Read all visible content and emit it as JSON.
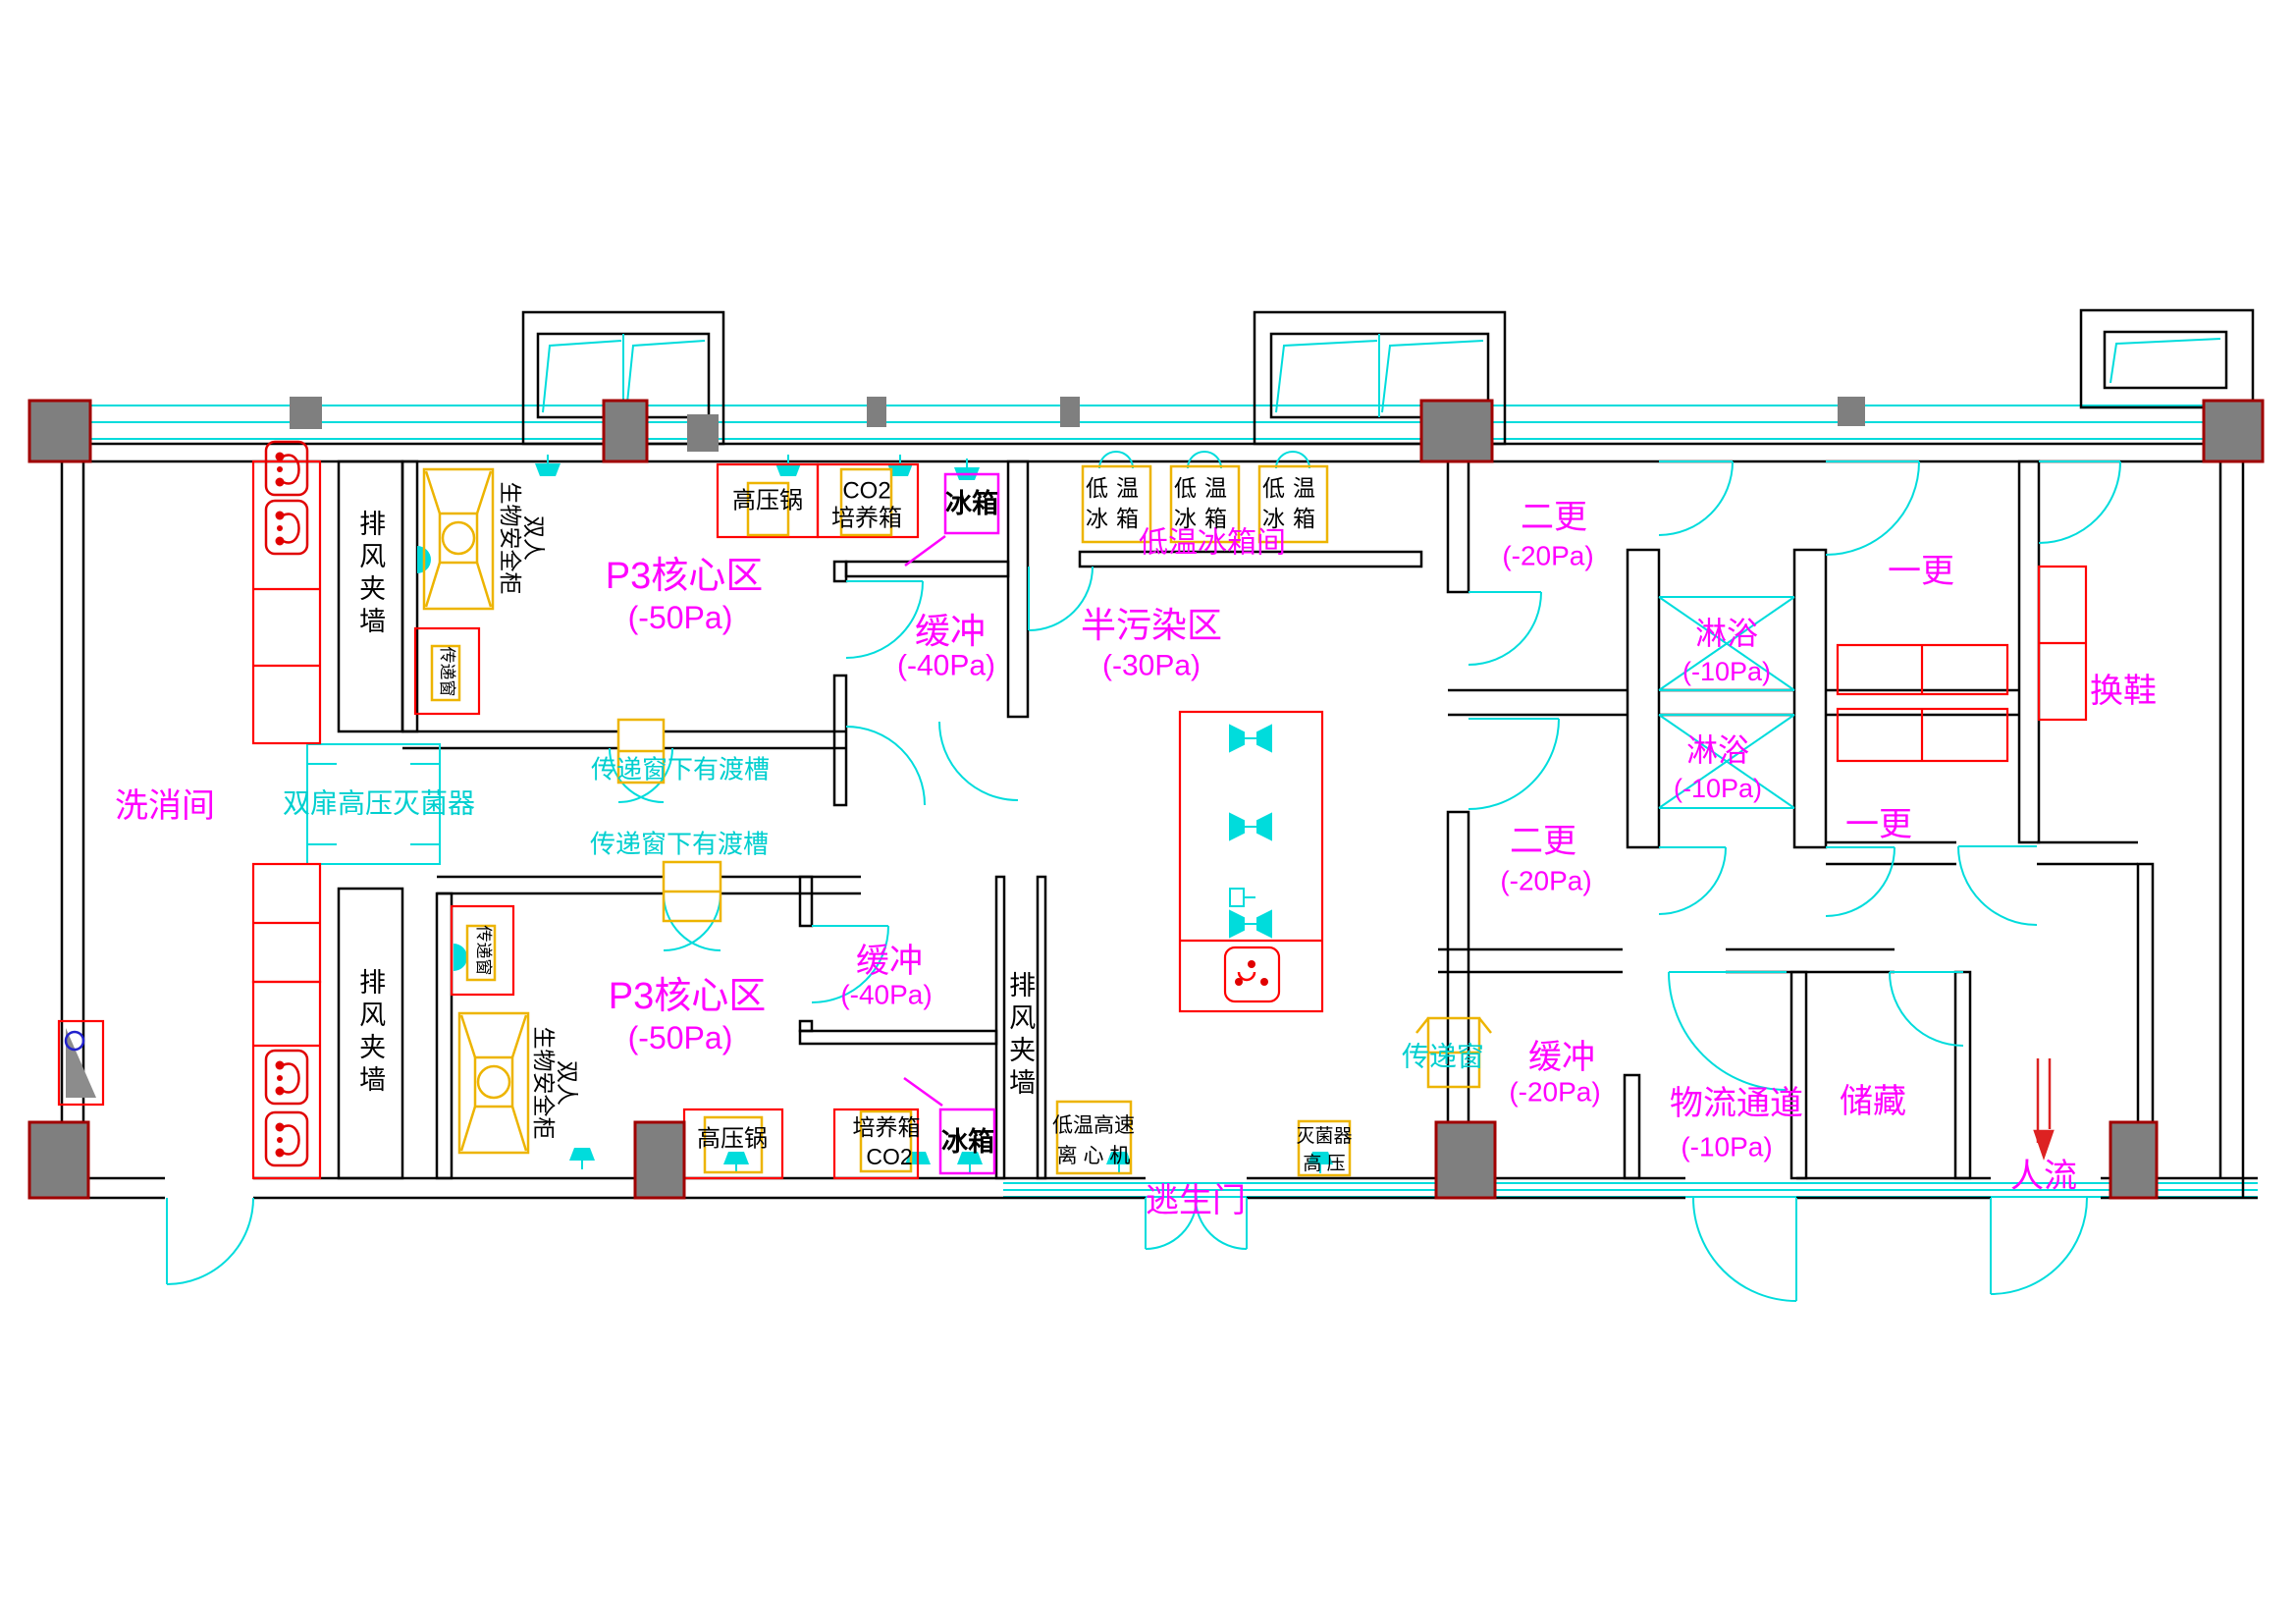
{
  "meta": {
    "drawing_type": "P3 biosafety laboratory floor plan"
  },
  "colors": {
    "wall": "#000000",
    "door_cyan": "#00DCDC",
    "room_label_magenta": "#FF00FF",
    "equipment_red": "#FF0000",
    "equipment_yellow": "#EDB400",
    "column_gray": "#7F7F7F",
    "column_border_dark_red": "#A00000",
    "flow_arrow_red": "#DD2222",
    "drain_blue": "#2222CC"
  },
  "rooms": {
    "wash": {
      "name": "洗消间"
    },
    "p3_core_upper": {
      "name": "P3核心区",
      "pressure": "(-50Pa)"
    },
    "p3_core_lower": {
      "name": "P3核心区",
      "pressure": "(-50Pa)"
    },
    "buffer_upper": {
      "name": "缓冲",
      "pressure": "(-40Pa)"
    },
    "buffer_lower": {
      "name": "缓冲",
      "pressure": "(-40Pa)"
    },
    "semi_contaminated": {
      "name": "半污染区",
      "pressure": "(-30Pa)"
    },
    "freezer_room": {
      "name": "低温冰箱间"
    },
    "second_change_upper": {
      "name": "二更",
      "pressure": "(-20Pa)"
    },
    "second_change_lower": {
      "name": "二更",
      "pressure": "(-20Pa)"
    },
    "shower_upper": {
      "name": "淋浴",
      "pressure": "(-10Pa)"
    },
    "shower_lower": {
      "name": "淋浴",
      "pressure": "(-10Pa)"
    },
    "first_change_upper": {
      "name": "一更"
    },
    "first_change_lower": {
      "name": "一更"
    },
    "shoe_change": {
      "name": "换鞋"
    },
    "buffer_right": {
      "name": "缓冲",
      "pressure": "(-20Pa)"
    },
    "logistics": {
      "name": "物流通道",
      "pressure": "(-10Pa)"
    },
    "storage": {
      "name": "储藏"
    }
  },
  "corridors": {
    "exhaust_plenum": "排风夹墙"
  },
  "annotations": {
    "autoclave_double_door": "双扉高压灭菌器",
    "pass_window_trough_note": "传递窗下有渡槽",
    "pass_window": "传递窗",
    "escape_door": "逃生门",
    "people_flow": "人流"
  },
  "equipment": {
    "biosafety_cabinet_line1": "双人",
    "biosafety_cabinet_line2": "生物安全柜",
    "autoclave_pot": "高压锅",
    "co2_incubator_line1": "CO2",
    "co2_incubator_line2": "培养箱",
    "incubator_line1": "培养箱",
    "incubator_line2": "CO2",
    "fridge": "冰箱",
    "low_temp_fridge_line1": "低温",
    "low_temp_fridge_line2": "冰箱",
    "centrifuge_line1": "低温高速",
    "centrifuge_line2": "离 心 机",
    "sterilizer_line1": "灭菌器",
    "sterilizer_line2": "高  压"
  }
}
